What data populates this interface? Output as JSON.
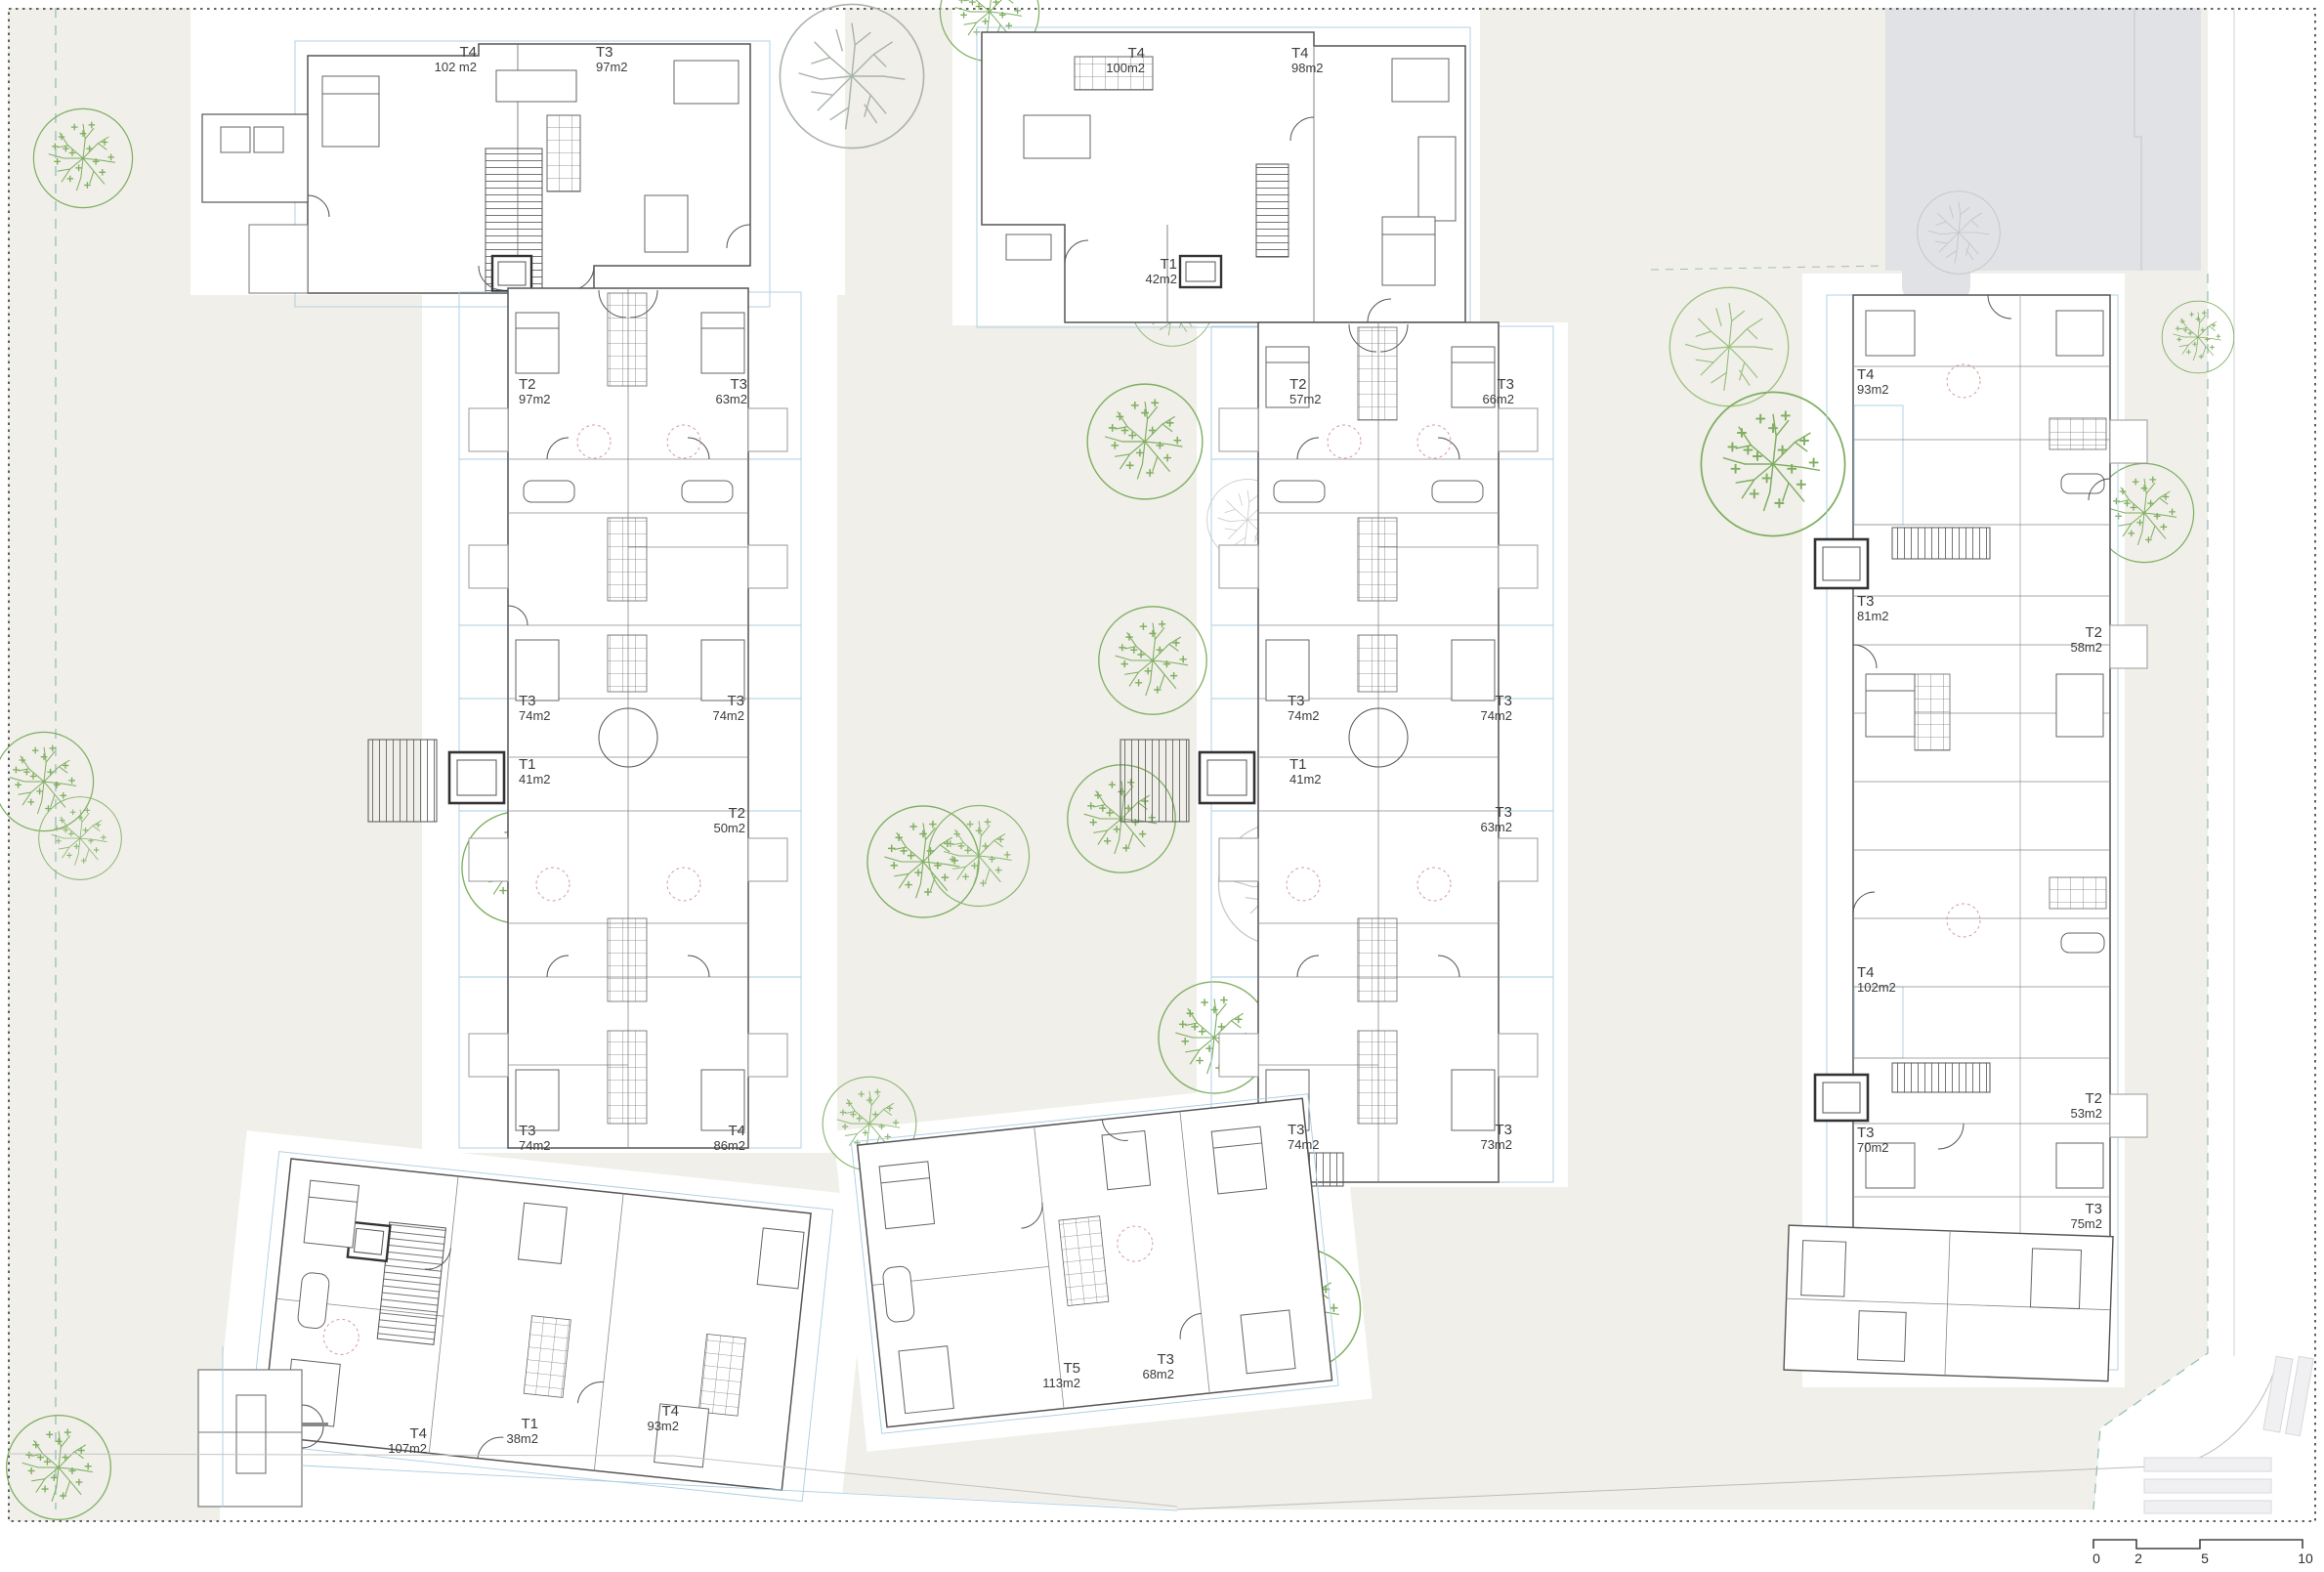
{
  "plan": {
    "units": [
      {
        "type": "T4",
        "area": "102 m2"
      },
      {
        "type": "T3",
        "area": "97m2"
      },
      {
        "type": "T4",
        "area": "100m2"
      },
      {
        "type": "T4",
        "area": "98m2"
      },
      {
        "type": "T1",
        "area": "42m2"
      },
      {
        "type": "T2",
        "area": "97m2"
      },
      {
        "type": "T3",
        "area": "63m2"
      },
      {
        "type": "T3",
        "area": "74m2"
      },
      {
        "type": "T3",
        "area": "74m2"
      },
      {
        "type": "T1",
        "area": "41m2"
      },
      {
        "type": "T2",
        "area": "50m2"
      },
      {
        "type": "T3",
        "area": "74m2"
      },
      {
        "type": "T4",
        "area": "86m2"
      },
      {
        "type": "T2",
        "area": "57m2"
      },
      {
        "type": "T3",
        "area": "66m2"
      },
      {
        "type": "T3",
        "area": "74m2"
      },
      {
        "type": "T3",
        "area": "74m2"
      },
      {
        "type": "T1",
        "area": "41m2"
      },
      {
        "type": "T3",
        "area": "63m2"
      },
      {
        "type": "T3",
        "area": "74m2"
      },
      {
        "type": "T3",
        "area": "73m2"
      },
      {
        "type": "T4",
        "area": "93m2"
      },
      {
        "type": "T3",
        "area": "81m2"
      },
      {
        "type": "T2",
        "area": "58m2"
      },
      {
        "type": "T4",
        "area": "102m2"
      },
      {
        "type": "T2",
        "area": "53m2"
      },
      {
        "type": "T3",
        "area": "70m2"
      },
      {
        "type": "T3",
        "area": "75m2"
      },
      {
        "type": "T4",
        "area": "107m2"
      },
      {
        "type": "T1",
        "area": "38m2"
      },
      {
        "type": "T4",
        "area": "93m2"
      },
      {
        "type": "T5",
        "area": "113m2"
      },
      {
        "type": "T3",
        "area": "68m2"
      }
    ],
    "colors": {
      "site_beige": "#f0efe9",
      "existing_building_gray": "#e0e2e6",
      "unit_line_blue": "#a9cde2",
      "tree_green": "#7fae60",
      "boundary_teal": "#8fbcb4",
      "wall_dark": "#555555"
    }
  },
  "scale_bar": {
    "ticks": [
      "0",
      "2",
      "5",
      "10"
    ]
  }
}
